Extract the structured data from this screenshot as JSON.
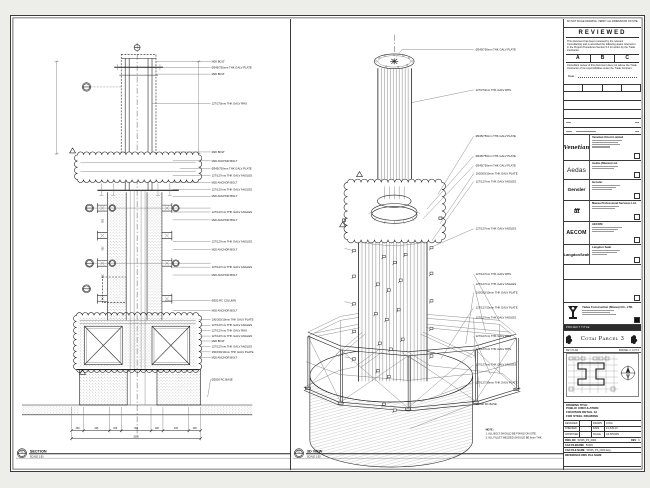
{
  "sheet": {
    "left_view": {
      "number": "01",
      "title": "SECTION",
      "scale": "SCALE 1:50",
      "labels": [
        "M20 BOLT",
        "Ø345/750mm THK GALV PLATE",
        "M20 BOLT",
        "127/273mm THK GALV RHS",
        "M20 BOLT",
        "M20 ANCHOR BOLT",
        "Ø345/750mm THK GALV PLATE",
        "127/127mm THK GALV ANGLES",
        "M20 ANCHOR BOLT",
        "127/127mm THK GALV ANGLES",
        "M20 ANCHOR BOLT",
        "127/127mm THK GALV ANGLES",
        "M20 ANCHOR BOLT",
        "127/127mm THK GALV ANGLES",
        "M20 ANCHOR BOLT",
        "127/127mm THK GALV ANGLES",
        "M20 ANCHOR BOLT",
        "Ø300 RC COLUMN",
        "M20 ANCHOR BOLT",
        "100/200/10mm THK GALV PLATE",
        "127/127mm THK GALV ANGLES",
        "127/127mm THK GALV RHS",
        "127/127mm THK GALV ANGLES",
        "M20 BOLT",
        "127/127mm THK GALV ANGLES",
        "150/150/10mm THK GALV PLATE",
        "M20 ANCHOR BOLT",
        "Ø2000 RC BASE"
      ],
      "dims": [
        "200",
        "445",
        "200",
        "450",
        "200",
        "445",
        "200"
      ],
      "dim_total": "2050",
      "dims_v": [
        "500",
        "500",
        "500"
      ]
    },
    "right_view": {
      "number": "02",
      "title": "3D VIEW",
      "scale": "SCALE 1:50",
      "labels": [
        "Ø345/750mm THK GALV PLATE",
        "127/273mm THK GALV RHS",
        "Ø345/750mm THK GALV PLATE",
        "Ø345/750mm THK GALV PLATE",
        "Ø345/750mm THK GALV PLATE",
        "100/200/10mm THK GALV PLATE",
        "127/127mm THK GALV ANGLES",
        "127/127mm THK GALV ANGLES",
        "127/127mm THK GALV RHS",
        "127/127mm THK GALV ANGLES",
        "100/200/10mm THK GALV PLATE",
        "127/127/10mm THK GALV PLATE",
        "127/127mm THK GALV ANGLES",
        "127/127mm THK GALV RHS",
        "127/127mm THK GALV RHS",
        "127/127mm THK GALV ANGLES",
        "127/127/10mm THK GALV PLATE",
        "Ø2000 RC BASE"
      ],
      "note_title": "NOTE:",
      "note_1": "1. ALL BOLT SHOULD BE FIXING ON SITE.",
      "note_2": "2. ALL FILLET WELDED SHOULD BE 6mm THK."
    },
    "title_block": {
      "top_note": "DO NOT SCALE DRAWING. VERIFY ALL DIMENSIONS ON SITE.",
      "stamp": {
        "title": "REVIEWED",
        "para1": "This document has been reviewed by the relevant Consultant(s) and is accorded the following status referred to in the Project Procedures Section 5.4 for action by the Trade Contractor.",
        "grade_a": "A",
        "grade_b": "B",
        "grade_c": "C",
        "para2": "Consultant review of this document does not relieve the Trade Contractor of its responsibilities under the Trade Contract.",
        "date_label": "Date :"
      },
      "companies": [
        {
          "logo": "Venetian",
          "name": "Venetian Orient Limited"
        },
        {
          "logo": "Aedas",
          "name": "Aedas (Macau) Ltd."
        },
        {
          "logo": "Gensler",
          "name": "Gensler"
        },
        {
          "logo": "ttt",
          "name": "Macau Professional Services Ltd."
        },
        {
          "logo": "AECOM",
          "name": "AECOM"
        },
        {
          "logo": "LangdonSeah",
          "name": "Langdon Seah"
        }
      ],
      "contractor": {
        "name": "Yadea Construction (Macau) CO., LTD."
      },
      "project_title_label": "PROJECT TITLE",
      "project_title": "Cotai Parcel 3",
      "key_plan_label": "KEY PLAN",
      "key_plan_parcel": "PARCEL 3, LOT 2",
      "drawing": {
        "title_label": "DRAWING TITLE:",
        "line1": "PUBLIC CIRCULATION",
        "line2": "FOUNTAIN DETAIL 1A",
        "line3": "FOR STEEL DRAWING",
        "designed_label": "DESIGNED",
        "designed": "",
        "drawn_label": "DRAWN",
        "drawn": "LUNG",
        "checked_label": "CHECKED",
        "checked": "-",
        "date_label": "DATE",
        "date": "14-JUN-10",
        "approved_label": "APPROVED",
        "approved": "-",
        "scale_label": "SCALE",
        "scale": "AS SHOWN",
        "dwgno_label": "DWG NO",
        "dwgno": "51545_PS_0000",
        "rev_label": "REV",
        "rev": "C",
        "cad_label": "CAD FILENAME",
        "cad": "51545",
        "cadfile_label": "CAD FILE NAME",
        "cadfile": "51545_PS_0000.dwg",
        "ref_label": "REFERENCE DWG FILE NAME"
      }
    }
  }
}
